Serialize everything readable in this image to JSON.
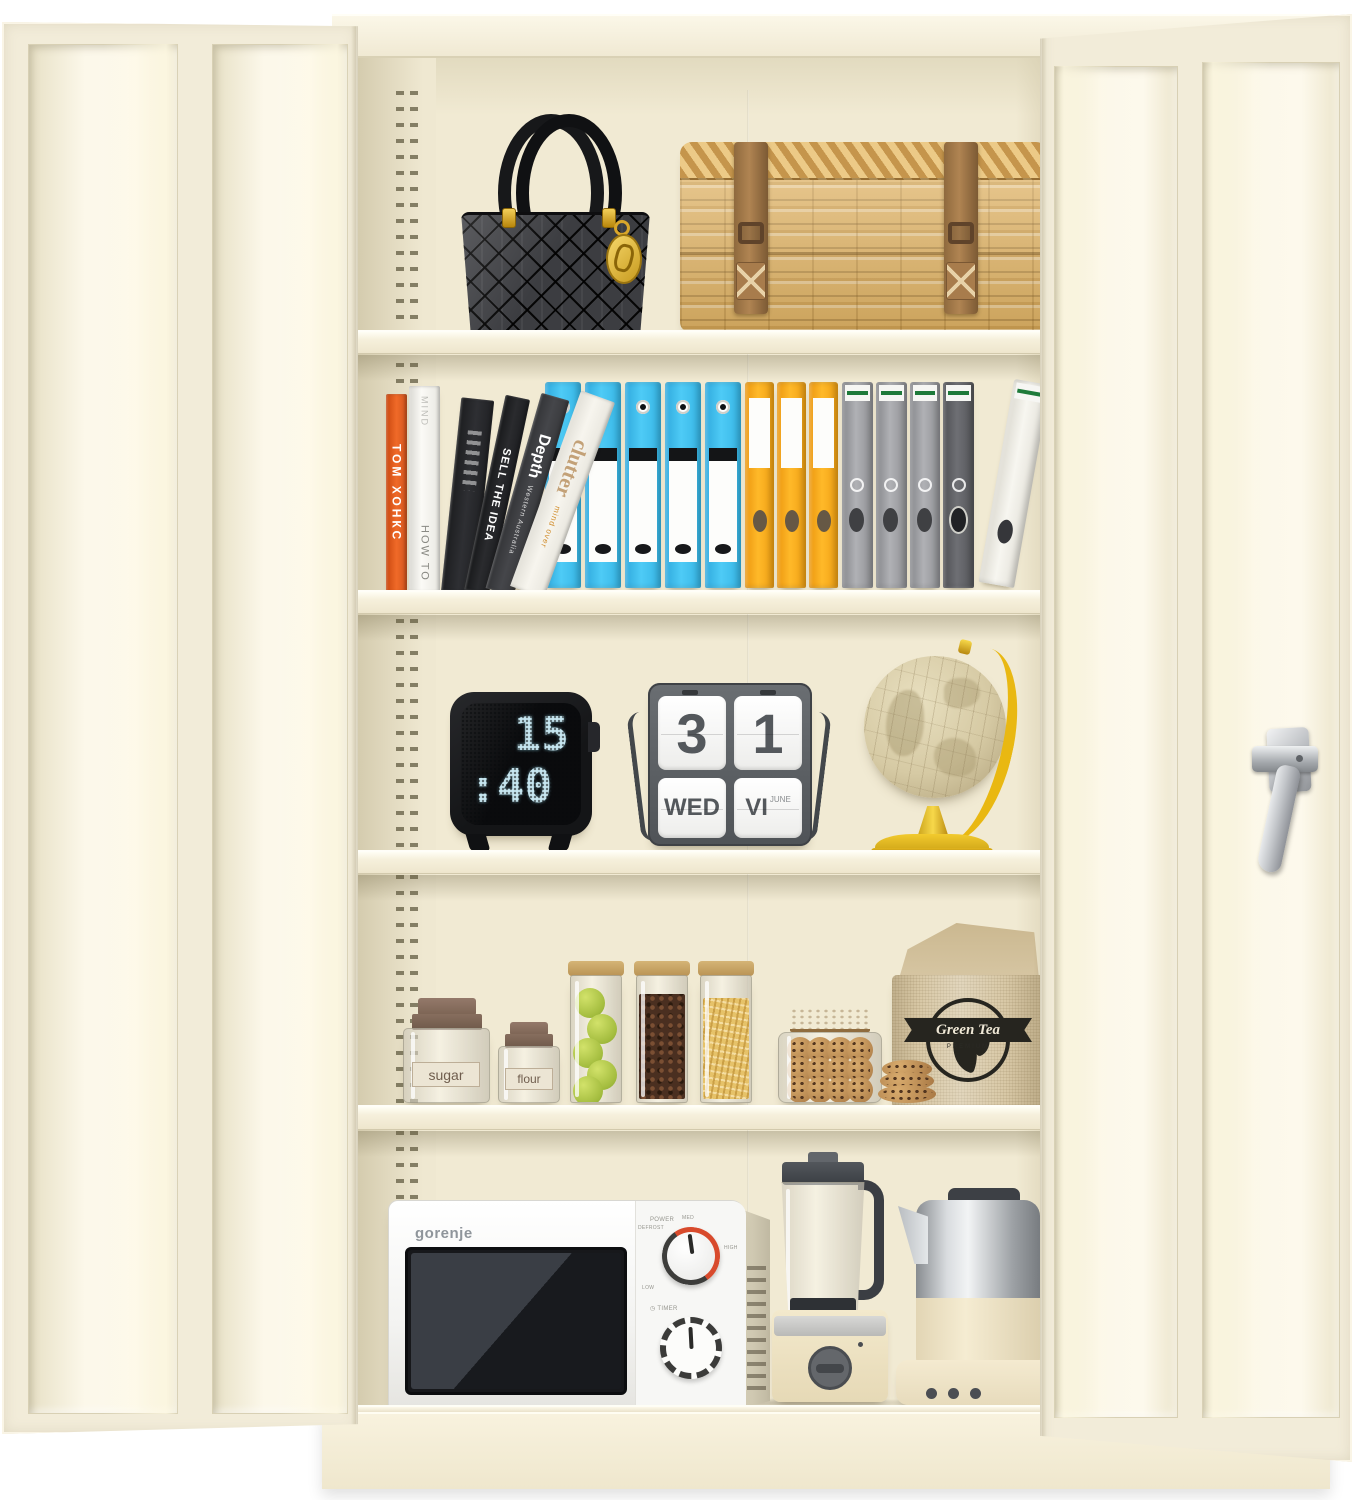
{
  "photo": {
    "subject": "Cream metal storage cabinet with both doors open showing five styled shelves",
    "colors": {
      "cabinet": "#f2ecd9",
      "interior_wall": "#f1ead3",
      "shelf_face": "#f6f0dc",
      "binder_blue": "#41c3f1",
      "binder_orange": "#f6a81c",
      "binder_gray": "#97989c",
      "book_orange": "#e0551d",
      "wicker": "#dfb46a",
      "strap_leather": "#9c7045",
      "clock_digits": "#c6e6f0",
      "calendar_frame": "#5c6064",
      "globe_gold": "#e9b812",
      "dial_accent_red": "#d84a2c",
      "cork": "#c29b63",
      "burlap": "#d8c8a6"
    }
  },
  "shelf2": {
    "books": {
      "spine1_title": "ТОМ ХОНКС",
      "spine2_top": "MIND",
      "spine2_bottom": "HOW TO",
      "spine4_title": "SELL THE IDEA",
      "spine5_title": "Depth",
      "spine5_subtitle": "Western Australia",
      "spine6_title": "clutter",
      "spine6_subtitle": "mind over"
    }
  },
  "shelf3": {
    "clock": {
      "hours": "15",
      "minutes": ":40"
    },
    "calendar": {
      "date_tens": "3",
      "date_ones": "1",
      "weekday": "WED",
      "month_roman": "VI",
      "month_name": "JUNE"
    }
  },
  "shelf4": {
    "sugar_label": "sugar",
    "flour_label": "flour",
    "tea_bag": {
      "brand": "Green Tea",
      "grade": "PREMIUM"
    }
  },
  "shelf5": {
    "microwave": {
      "brand": "gorenje",
      "power_label": "POWER",
      "timer_label": "TIMER",
      "power_levels": [
        "DEFROST",
        "MED",
        "HIGH",
        "LOW"
      ]
    }
  }
}
